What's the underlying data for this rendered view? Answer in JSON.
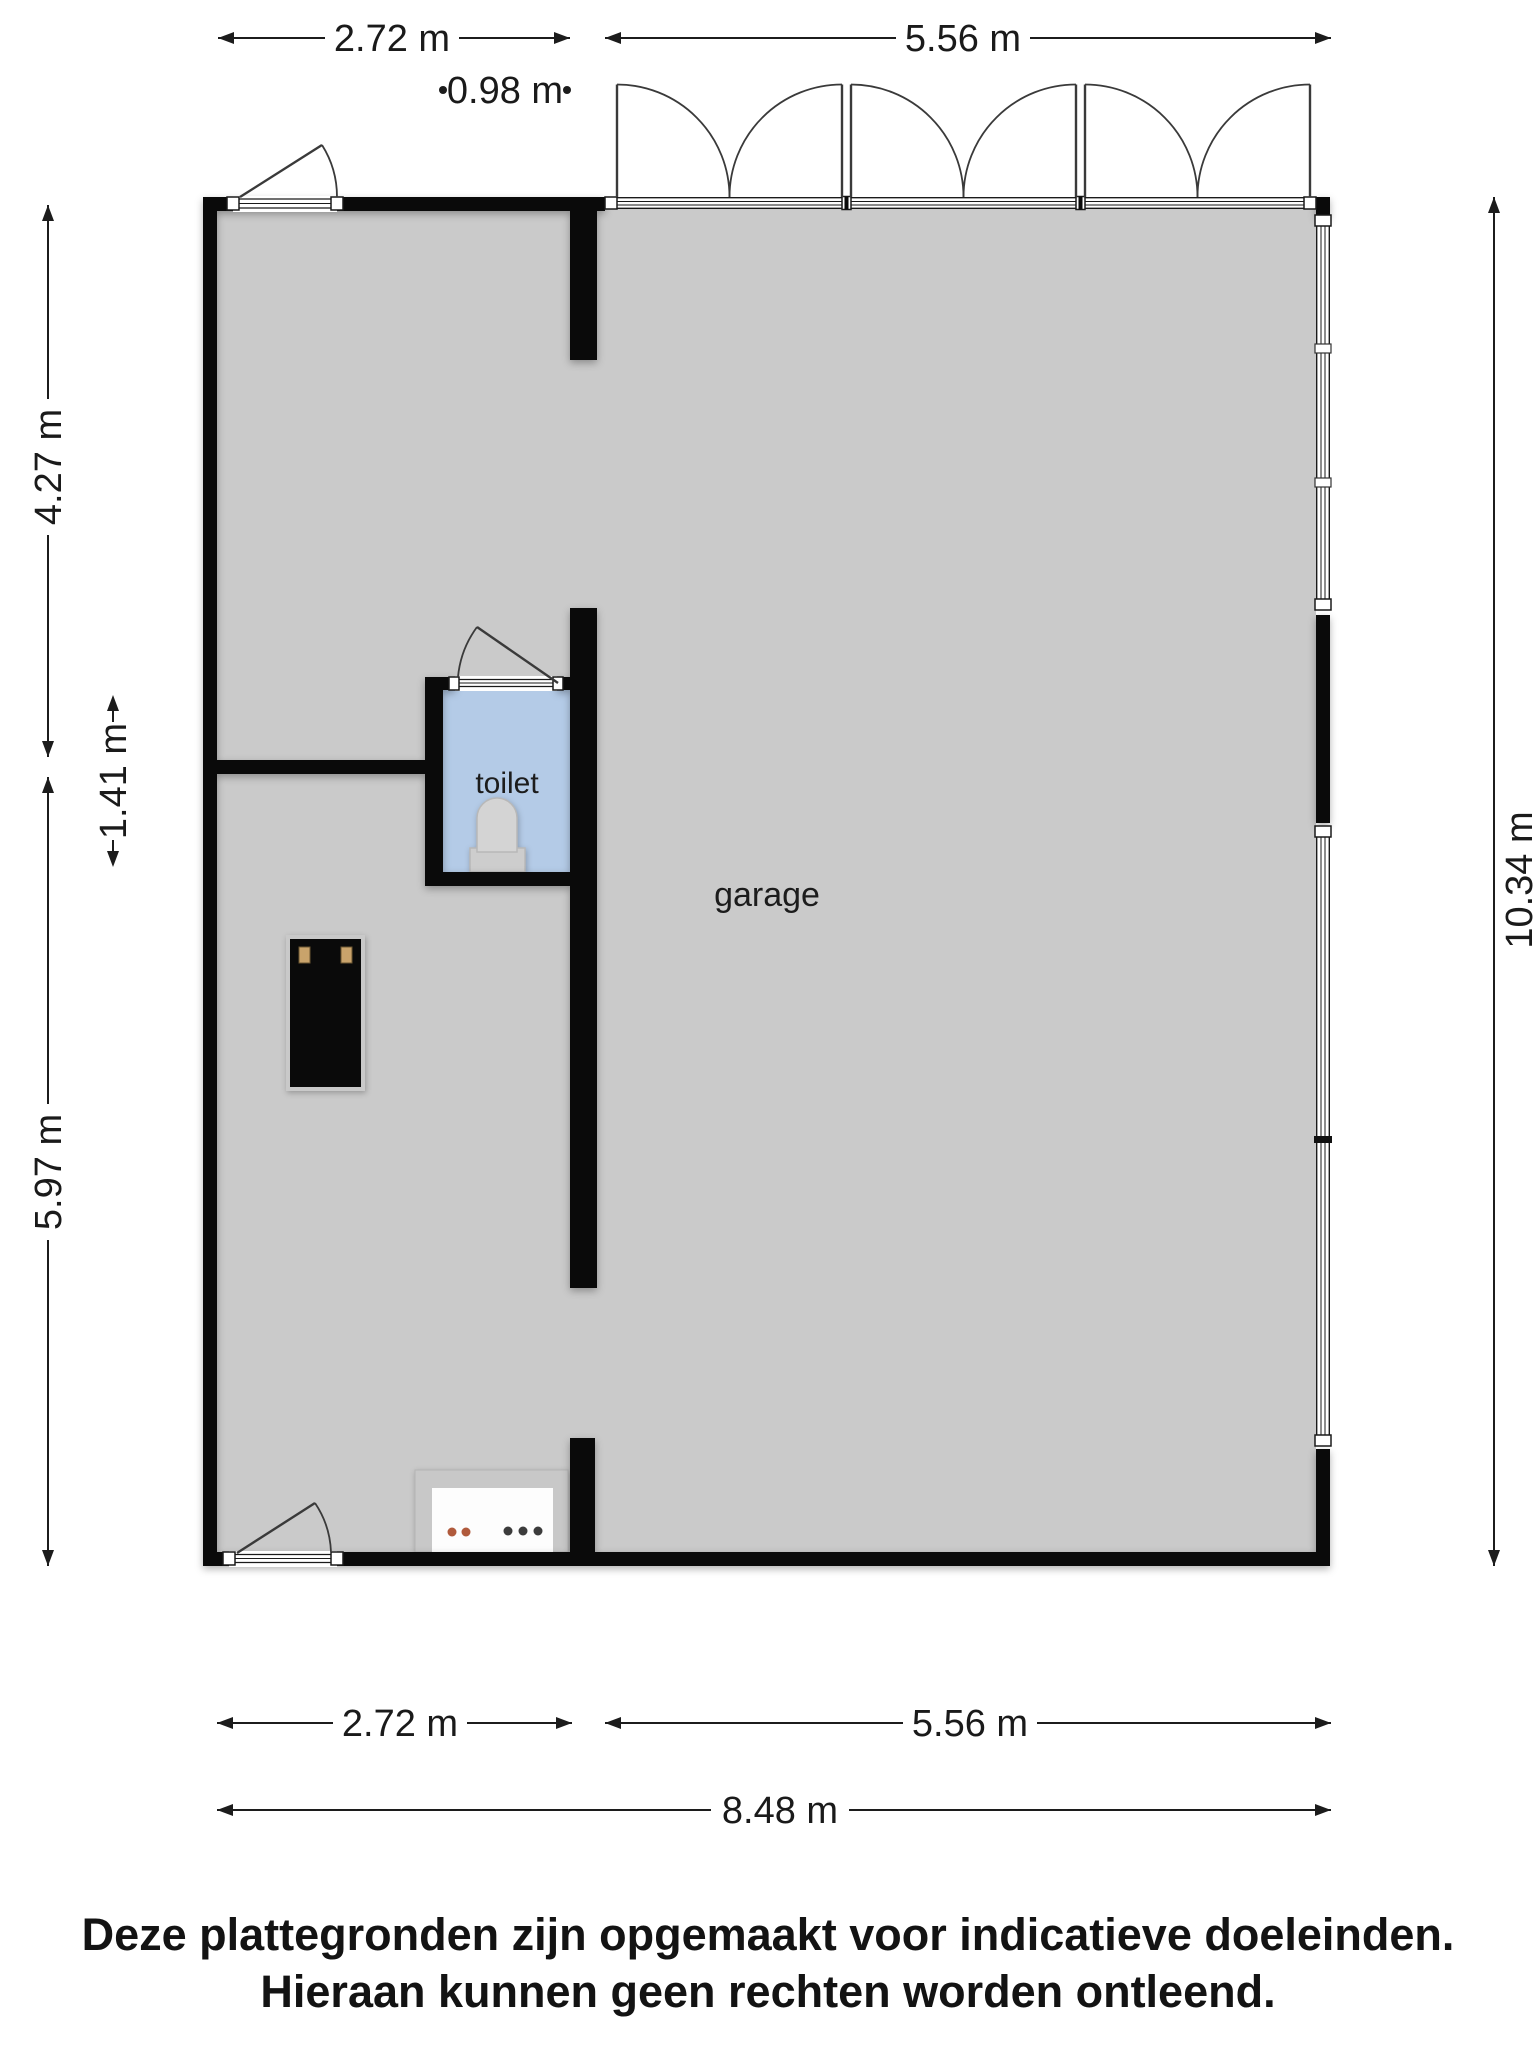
{
  "rooms": {
    "garage": "garage",
    "toilet": "toilet"
  },
  "dimensions": {
    "top_left": "2.72 m",
    "top_door": "0.98 m",
    "top_right": "5.56 m",
    "left_upper": "4.27 m",
    "left_toilet": "1.41 m",
    "left_lower": "5.97 m",
    "right_full": "10.34 m",
    "bottom_left": "2.72 m",
    "bottom_right": "5.56 m",
    "bottom_total": "8.48 m"
  },
  "disclaimer": {
    "line1": "Deze plattegronden zijn opgemaakt voor indicatieve doeleinden.",
    "line2": "Hieraan kunnen geen rechten worden ontleend."
  },
  "colors": {
    "floor": "#cacaca",
    "toilet_floor": "#b4cbe7",
    "wall": "#0a0a0a",
    "fixture": "#d4d4d4",
    "fixture_dark": "#cdcdcd",
    "cabinet": "#0a0a0a",
    "cabinet_trim": "#c9a36b",
    "counter_frame": "#c8c8c8",
    "counter_inner": "#fdfdfd",
    "knob_orange": "#b05a3c",
    "knob_dark": "#3c3c3c"
  }
}
